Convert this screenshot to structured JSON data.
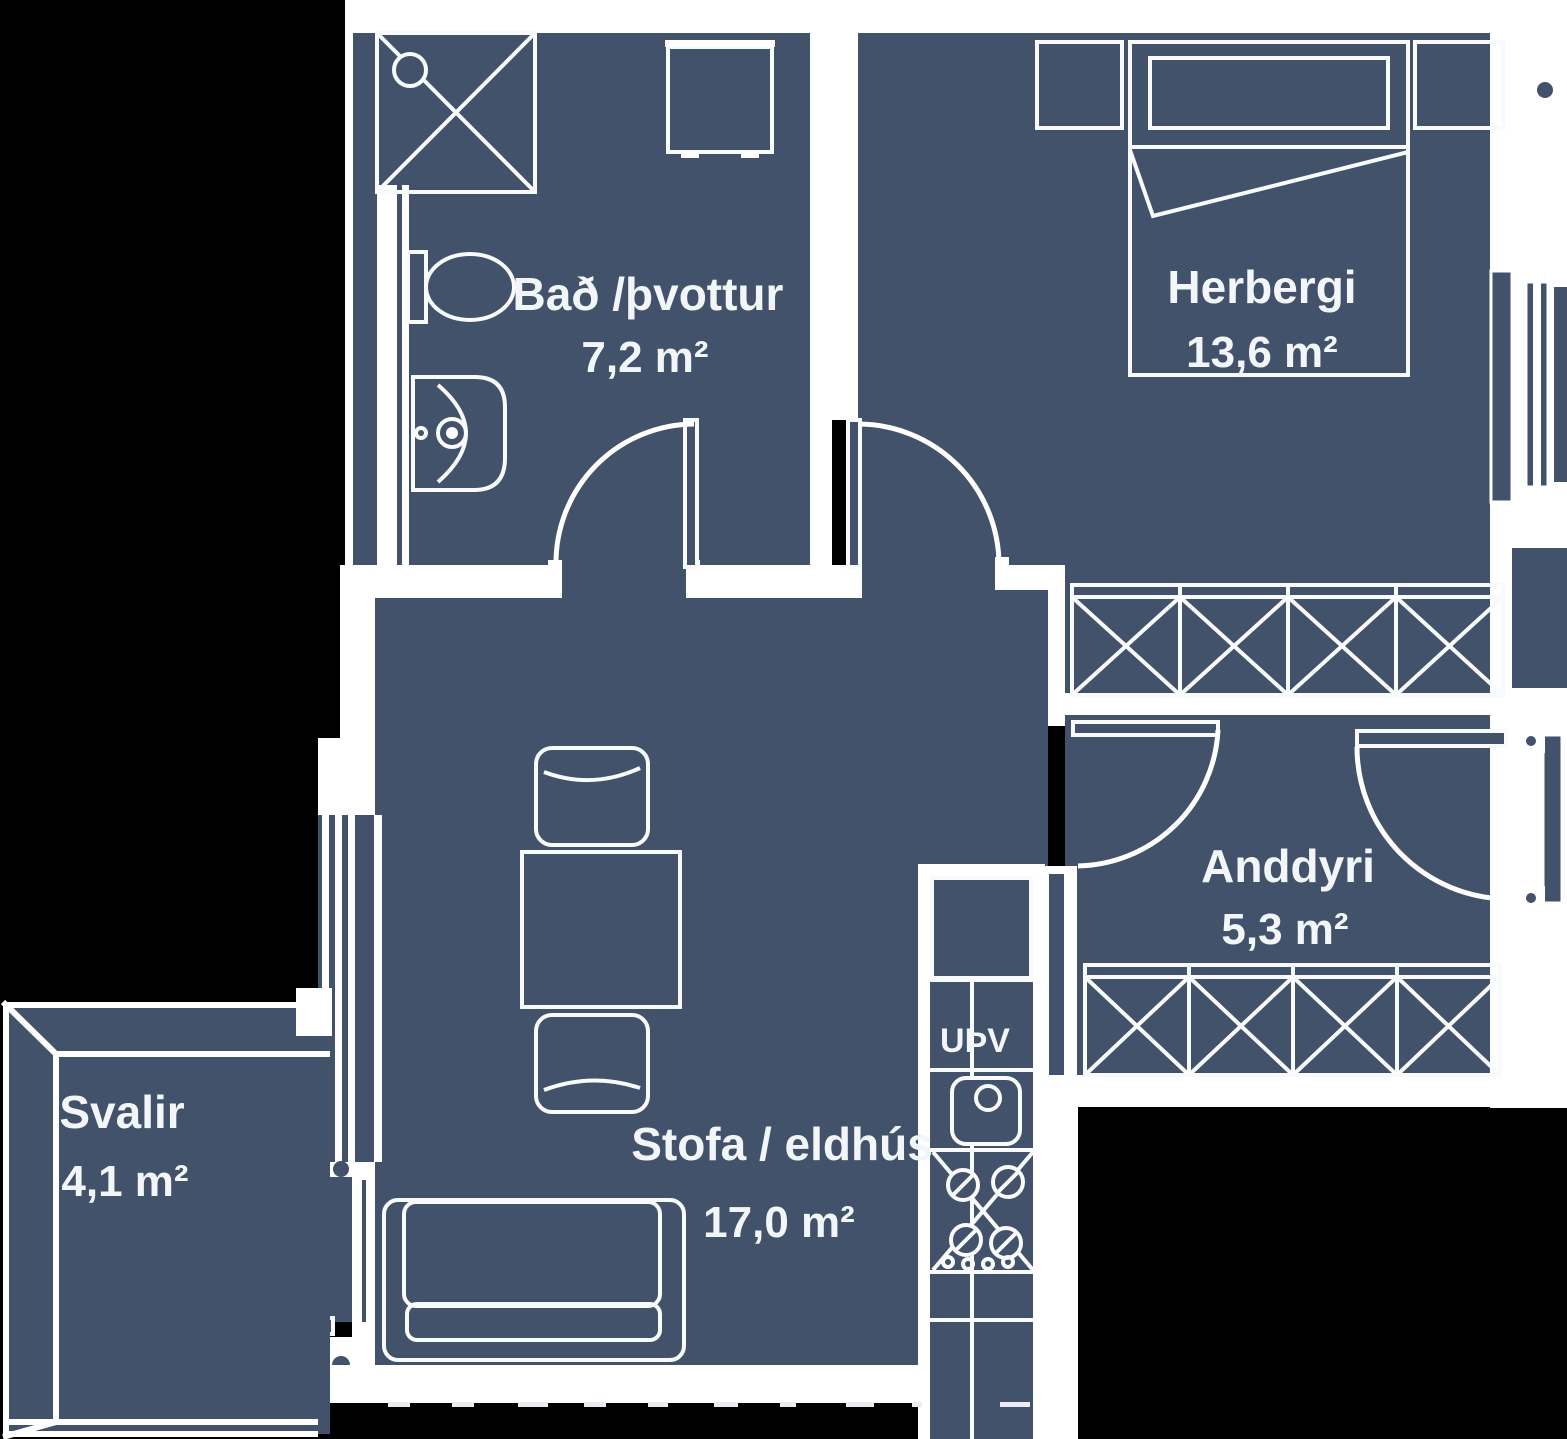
{
  "plan": {
    "title": "apartment-floor-plan",
    "colors": {
      "background": "#000000",
      "floor": "#41526A",
      "lines": "#FFFFFF",
      "text": "#F2F6F9"
    },
    "rooms": [
      {
        "id": "bathroom",
        "name": "Bað /þvottur",
        "area": "7,2 m²"
      },
      {
        "id": "bedroom",
        "name": "Herbergi",
        "area": "13,6 m²"
      },
      {
        "id": "entrance",
        "name": "Anddyri",
        "area": "5,3 m²"
      },
      {
        "id": "living_kitchen",
        "name": "Stofa / eldhús",
        "area": "17,0 m²"
      },
      {
        "id": "balcony",
        "name": "Svalir",
        "area": "4,1 m²"
      }
    ],
    "appliances": {
      "dishwasher_label": "UÞV"
    },
    "furniture_symbols": [
      "shower",
      "washing-machine",
      "toilet",
      "hand-basin",
      "double-bed",
      "nightstand",
      "wardrobe",
      "dining-table",
      "chair",
      "sofa",
      "refrigerator",
      "dishwasher",
      "kitchen-sink",
      "stove",
      "hinged-door",
      "entrance-door",
      "balcony-door",
      "window",
      "balcony-railing"
    ]
  }
}
